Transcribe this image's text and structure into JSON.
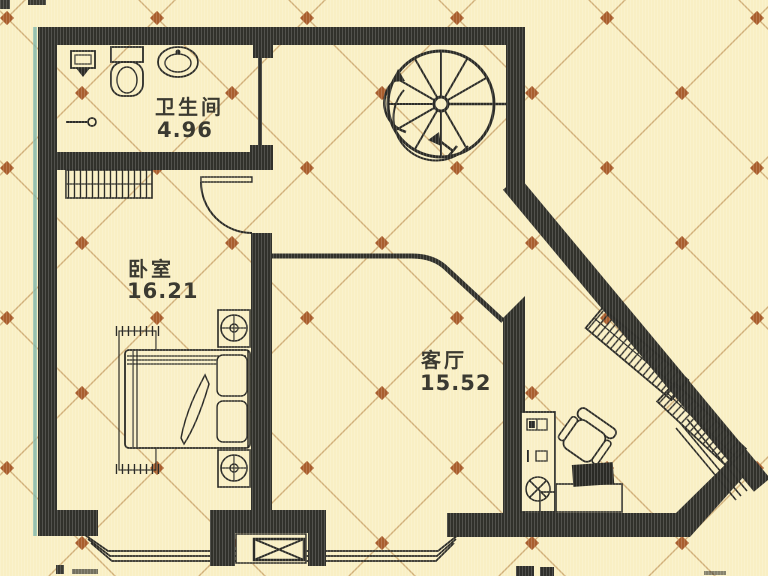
{
  "plan": {
    "rooms": [
      {
        "id": "bathroom",
        "name": "卫生间",
        "area": "4.96"
      },
      {
        "id": "bedroom",
        "name": "卧室",
        "area": "16.21"
      },
      {
        "id": "living-room",
        "name": "客厅",
        "area": "15.52"
      }
    ],
    "features": [
      "spiral-staircase-icon",
      "stair-direction-arrow-icon",
      "bedroom-door-swing-icon",
      "sliding-door-icon",
      "wardrobe-icon",
      "double-bed-icon",
      "pillow-icon",
      "nightstand-lamp-icon",
      "bed-rug-icon",
      "toilet-icon",
      "washbasin-icon",
      "mop-sink-icon",
      "towel-bar-icon",
      "desk-icon",
      "office-chair-icon",
      "monitor-icon",
      "cabinet-icon",
      "shaft-x-box-icon",
      "balcony-window-icon",
      "diagonal-shelving-icon",
      "railing-icon"
    ],
    "colors": {
      "background": "#f9efc4",
      "wall": "#31312b",
      "furniture_line": "#2c2c27",
      "lattice_line": "#c49a5e",
      "lattice_dot": "#a95e2d",
      "text": "#3b3a31",
      "scan_fringe": "#7fb6aa"
    }
  }
}
